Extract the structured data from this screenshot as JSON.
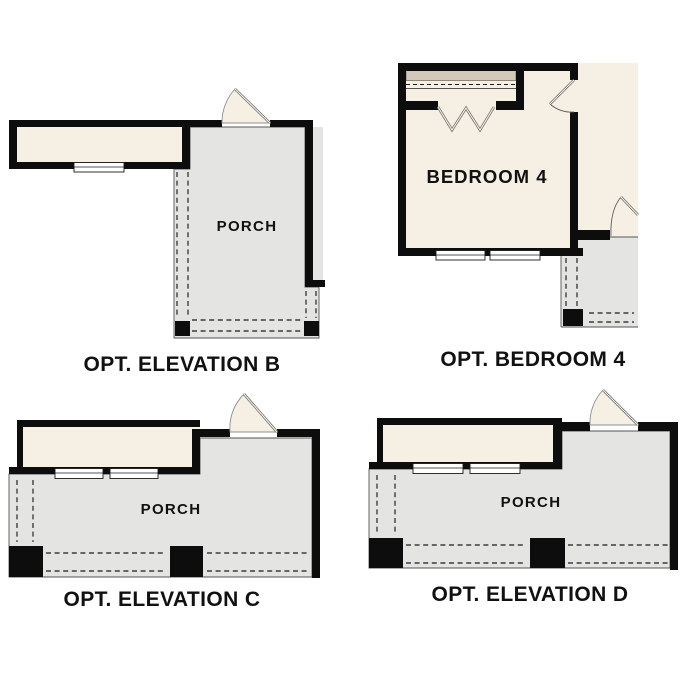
{
  "colors": {
    "wall": "#0d0d0d",
    "cream": "#f6efe3",
    "porch": "#e4e4e2",
    "tan": "#d3c9b8",
    "line": "#555555",
    "text": "#111111",
    "bg": "#ffffff",
    "win": "#ffffff"
  },
  "plans": {
    "elevation_b": {
      "title": "OPT. ELEVATION B",
      "porch_label": "PORCH"
    },
    "bedroom_4": {
      "title": "OPT. BEDROOM 4",
      "room_label": "BEDROOM 4"
    },
    "elevation_c": {
      "title": "OPT. ELEVATION C",
      "porch_label": "PORCH"
    },
    "elevation_d": {
      "title": "OPT. ELEVATION D",
      "porch_label": "PORCH"
    }
  }
}
